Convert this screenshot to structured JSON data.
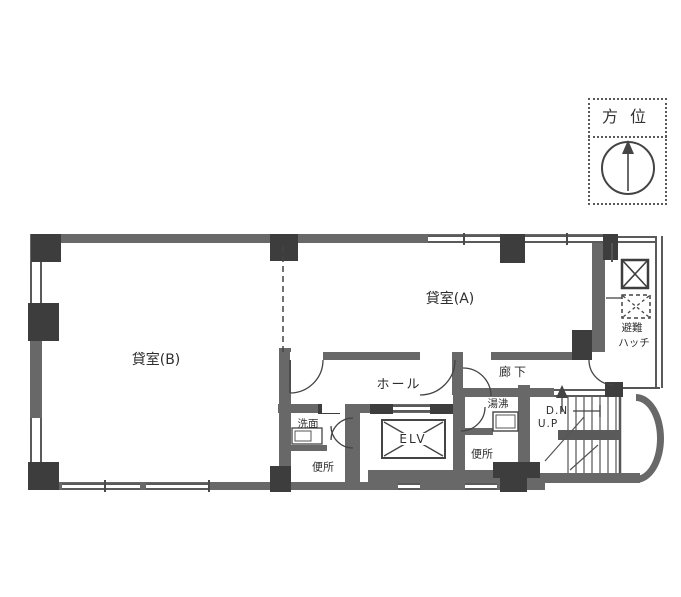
{
  "compass": {
    "label": "方位"
  },
  "rooms": {
    "room_b": {
      "label": "貸室(B)"
    },
    "room_a": {
      "label": "貸室(A)"
    },
    "hall": {
      "label": "ホール"
    },
    "corridor": {
      "label": "廊下"
    },
    "washroom": {
      "label": "洗面"
    },
    "toilet_left": {
      "label": "便所"
    },
    "toilet_right": {
      "label": "便所"
    },
    "water_heater": {
      "label": "湯沸"
    },
    "elevator": {
      "label": "ELV"
    }
  },
  "stairs": {
    "down": "D.N",
    "up": "U.P"
  },
  "hatch": {
    "line1": "避難",
    "line2": "ハッチ"
  },
  "colors": {
    "wall": "#686868",
    "pier": "#3d3d3d",
    "line": "#444444",
    "text": "#2e2e2e",
    "background": "#ffffff"
  }
}
